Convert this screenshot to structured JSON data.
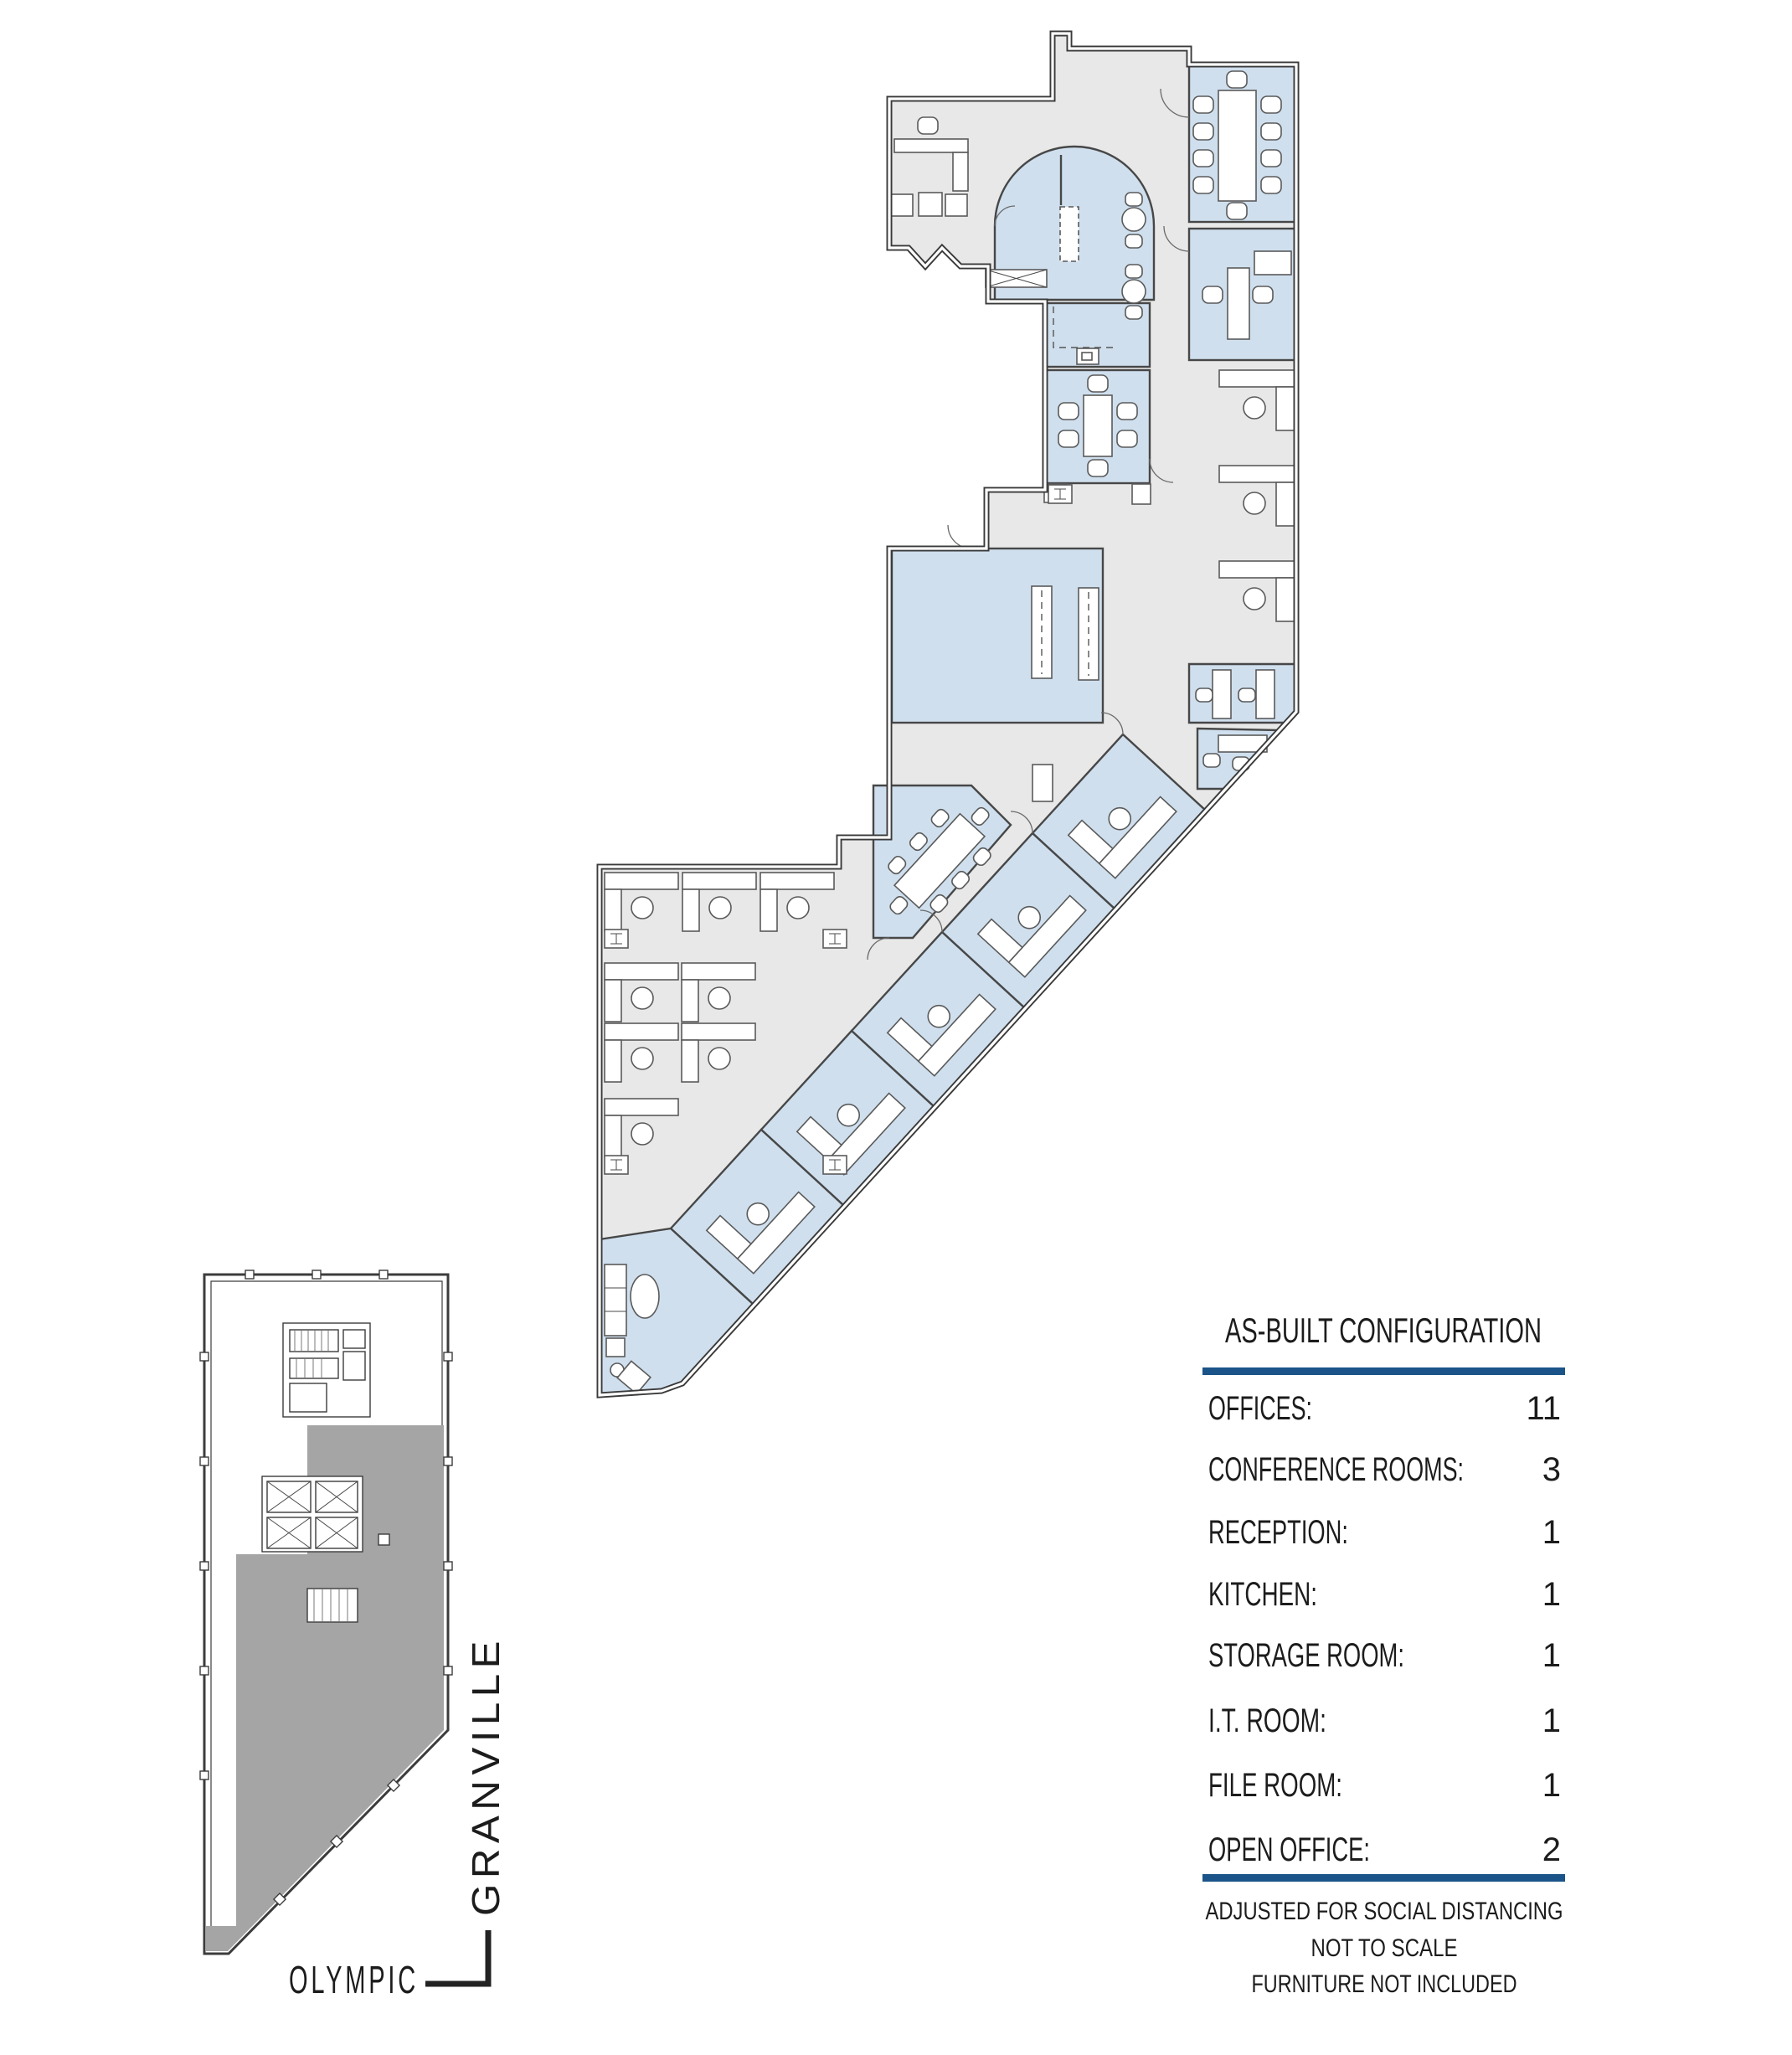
{
  "legend": {
    "title": "AS-BUILT CONFIGURATION",
    "rows": [
      {
        "label": "OFFICES:",
        "value": "11"
      },
      {
        "label": "CONFERENCE ROOMS:",
        "value": "3"
      },
      {
        "label": "RECEPTION:",
        "value": "1"
      },
      {
        "label": "KITCHEN:",
        "value": "1"
      },
      {
        "label": "STORAGE ROOM:",
        "value": "1"
      },
      {
        "label": "I.T. ROOM:",
        "value": "1"
      },
      {
        "label": "FILE ROOM:",
        "value": "1"
      },
      {
        "label": "OPEN OFFICE:",
        "value": "2"
      }
    ],
    "footnotes": [
      "ADJUSTED FOR SOCIAL DISTANCING",
      "NOT TO SCALE",
      "FURNITURE NOT INCLUDED"
    ],
    "rule_color": "#1a5488"
  },
  "key_plan": {
    "street_bottom": "OLYMPIC",
    "street_right": "GRANVILLE",
    "suite_fill": "#a5a5a5"
  },
  "floor_plan": {
    "room_fill": "#cfdfee",
    "floor_fill": "#e8e8e8",
    "wall_color": "#3a3a3a"
  }
}
